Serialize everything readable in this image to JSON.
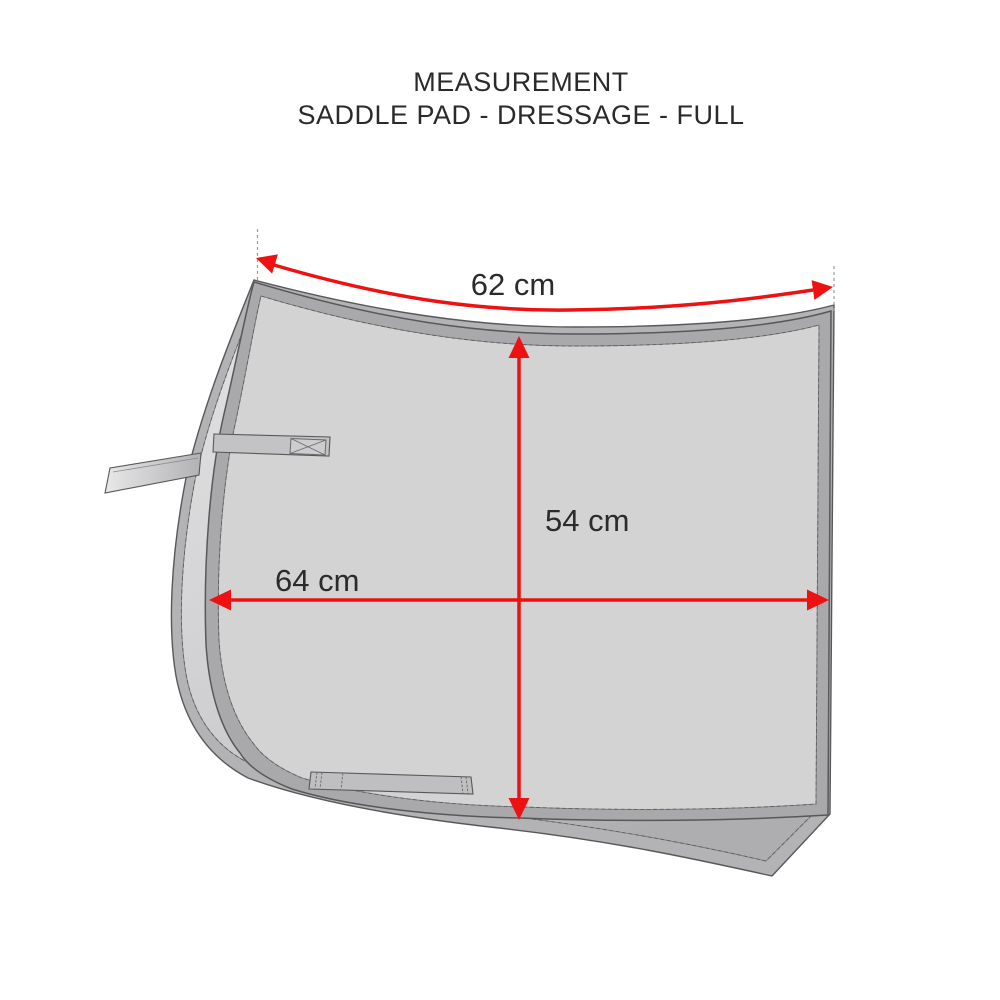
{
  "title": {
    "line1": "MEASUREMENT",
    "line2": "SADDLE PAD - DRESSAGE - FULL"
  },
  "diagram": {
    "subject": "saddle-pad-dressage-full-measurements",
    "measurements": [
      {
        "name": "top-edge-length",
        "label": "62 cm",
        "direction": "curved-along-top-edge"
      },
      {
        "name": "drop-height",
        "label": "54 cm",
        "direction": "vertical"
      },
      {
        "name": "bottom-length",
        "label": "64 cm",
        "direction": "horizontal"
      }
    ],
    "colors": {
      "arrow_red": "#ee1111",
      "pad_front_fill": "#d3d3d4",
      "pad_back_fill": "#c4c4c6",
      "binding_gray": "#a9a9ab",
      "outline_gray": "#58585a",
      "text_dark": "#2b2b2b",
      "background": "#ffffff"
    }
  }
}
